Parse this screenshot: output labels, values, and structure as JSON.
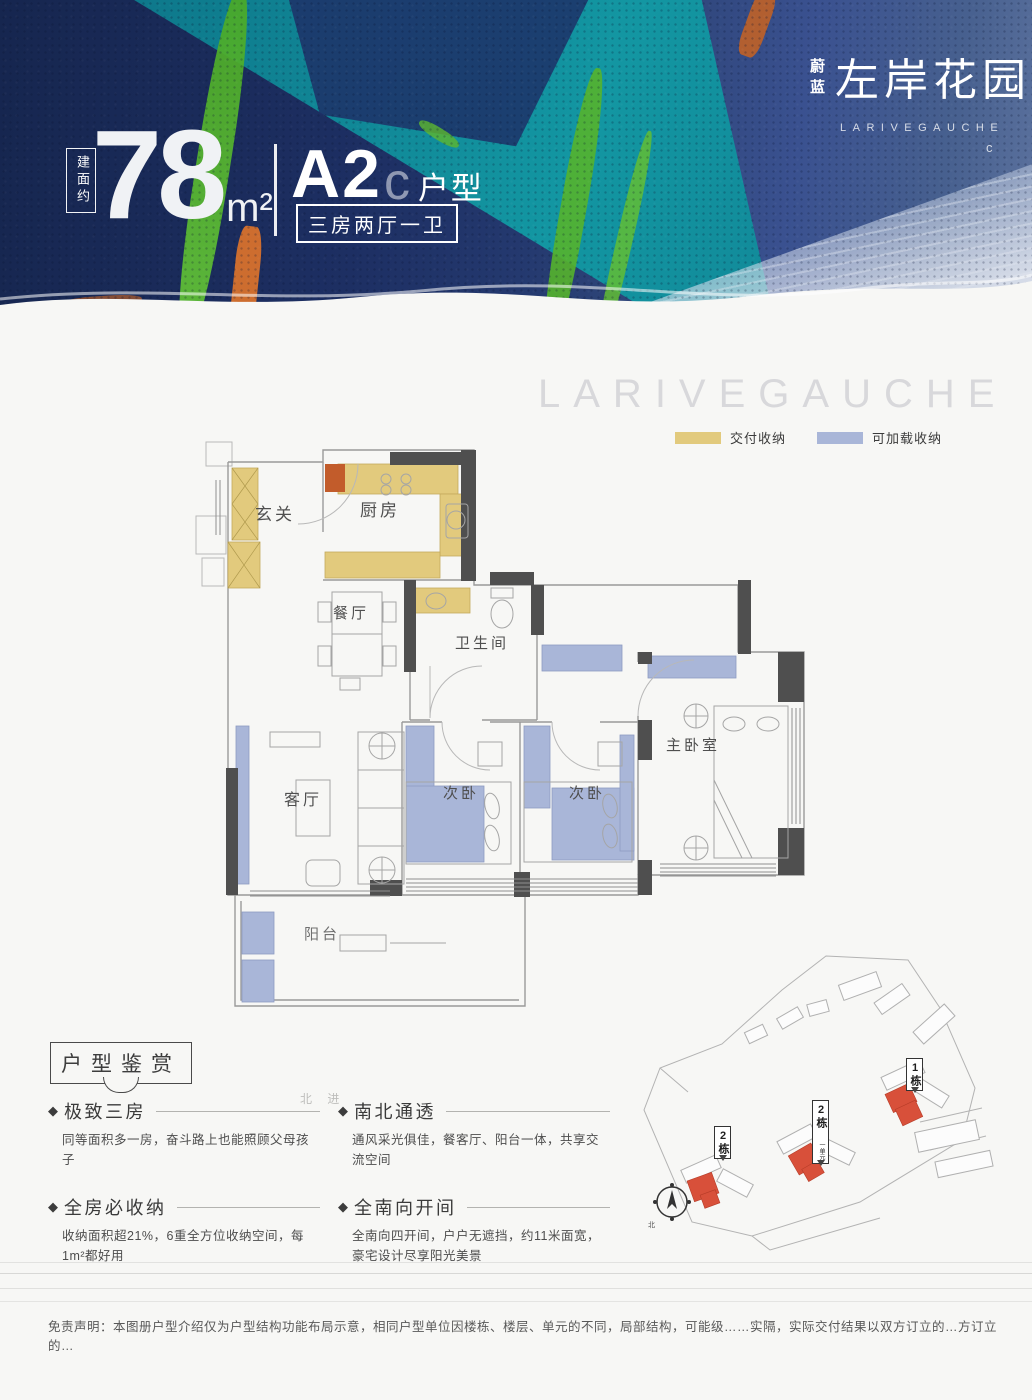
{
  "header": {
    "area_label": "建面约",
    "area_value": "78",
    "area_unit": "m²",
    "unit_code": "A2",
    "unit_code_suffix": "c",
    "unit_code_label": "户型",
    "layout_badge": "三房两厅一卫",
    "brand_prefix": "蔚蓝",
    "brand_name": "左岸花园",
    "brand_latin": "LARIVEGAUCHE",
    "corner_mark": "c"
  },
  "watermark": "LARIVEGAUCHE",
  "legend": {
    "delivered": {
      "label": "交付收纳",
      "color": "#e2ca7d"
    },
    "loadable": {
      "label": "可加载收纳",
      "color": "#a9b6d8"
    }
  },
  "floor_plan": {
    "rooms": [
      {
        "label": "玄关"
      },
      {
        "label": "厨房"
      },
      {
        "label": "餐厅"
      },
      {
        "label": "卫生间"
      },
      {
        "label": "客厅"
      },
      {
        "label": "次卧"
      },
      {
        "label": "次卧"
      },
      {
        "label": "主卧室"
      },
      {
        "label": "阳台"
      }
    ],
    "wall_color": "#4f4f4f",
    "delivered_storage_color": "#e2ca7d",
    "loadable_storage_color": "#a9b6d8",
    "fridge_color": "#c25c2b"
  },
  "features": {
    "section_title": "户型鉴赏",
    "artifact": "北 进",
    "items": [
      {
        "title": "极致三房",
        "desc": "同等面积多一房，奋斗路上也能照顾父母孩子"
      },
      {
        "title": "南北通透",
        "desc": "通风采光俱佳，餐客厅、阳台一体，共享交流空间"
      },
      {
        "title": "全房必收纳",
        "desc": "收纳面积超21%，6重全方位收纳空间，每1m²都好用"
      },
      {
        "title": "全南向开间",
        "desc": "全南向四开间，户户无遮挡，约11米面宽，豪宅设计尽享阳光美景"
      }
    ]
  },
  "site_plan": {
    "flags": [
      {
        "label": "1栋",
        "sub": ""
      },
      {
        "label": "2栋",
        "sub": "一单元"
      },
      {
        "label": "2栋",
        "sub": ""
      }
    ],
    "compass_label": "北",
    "highlight_color": "#d8503a"
  },
  "disclaimer": "免责声明：本图册户型介绍仅为户型结构功能布局示意，相同户型单位因楼栋、楼层、单元的不同，局部结构，可能级……实隔，实际交付结果以双方订立的…方订立的…"
}
